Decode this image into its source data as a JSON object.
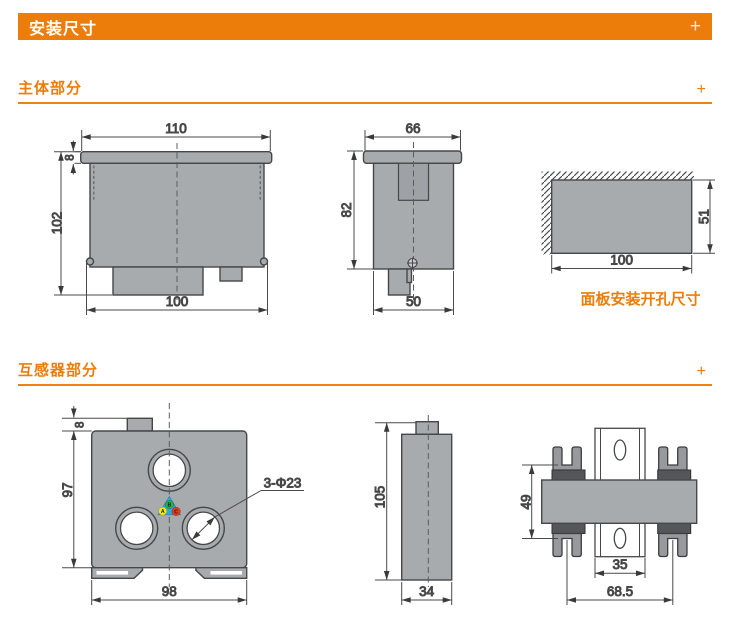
{
  "header": {
    "title": "安装尺寸",
    "expand_icon": "+"
  },
  "sections": {
    "main_body": {
      "title": "主体部分",
      "expand_icon": "+"
    },
    "transformer": {
      "title": "互感器部分",
      "expand_icon": "+"
    }
  },
  "colors": {
    "accent_orange": "#ED7D0B",
    "drawing_fill_gray": "#A8ABAE",
    "line_dark": "#45484B"
  },
  "drawings": {
    "main_front": {
      "width_top": "110",
      "bezel_height": "8",
      "total_height": "102",
      "width_bottom": "100"
    },
    "main_side": {
      "width_top": "66",
      "height": "82",
      "width_bottom": "50"
    },
    "panel_cutout": {
      "height": "51",
      "width": "100",
      "caption": "面板安装开孔尺寸"
    },
    "ct_front": {
      "tab_height": "8",
      "height": "97",
      "width": "98",
      "holes_label": "3-Φ23",
      "phase_a": "A",
      "phase_b": "B",
      "phase_c": "C"
    },
    "ct_side": {
      "height": "105",
      "width": "34"
    },
    "ct_top": {
      "clip_span": "49",
      "rail_width": "35",
      "clip_distance": "68.5"
    }
  }
}
